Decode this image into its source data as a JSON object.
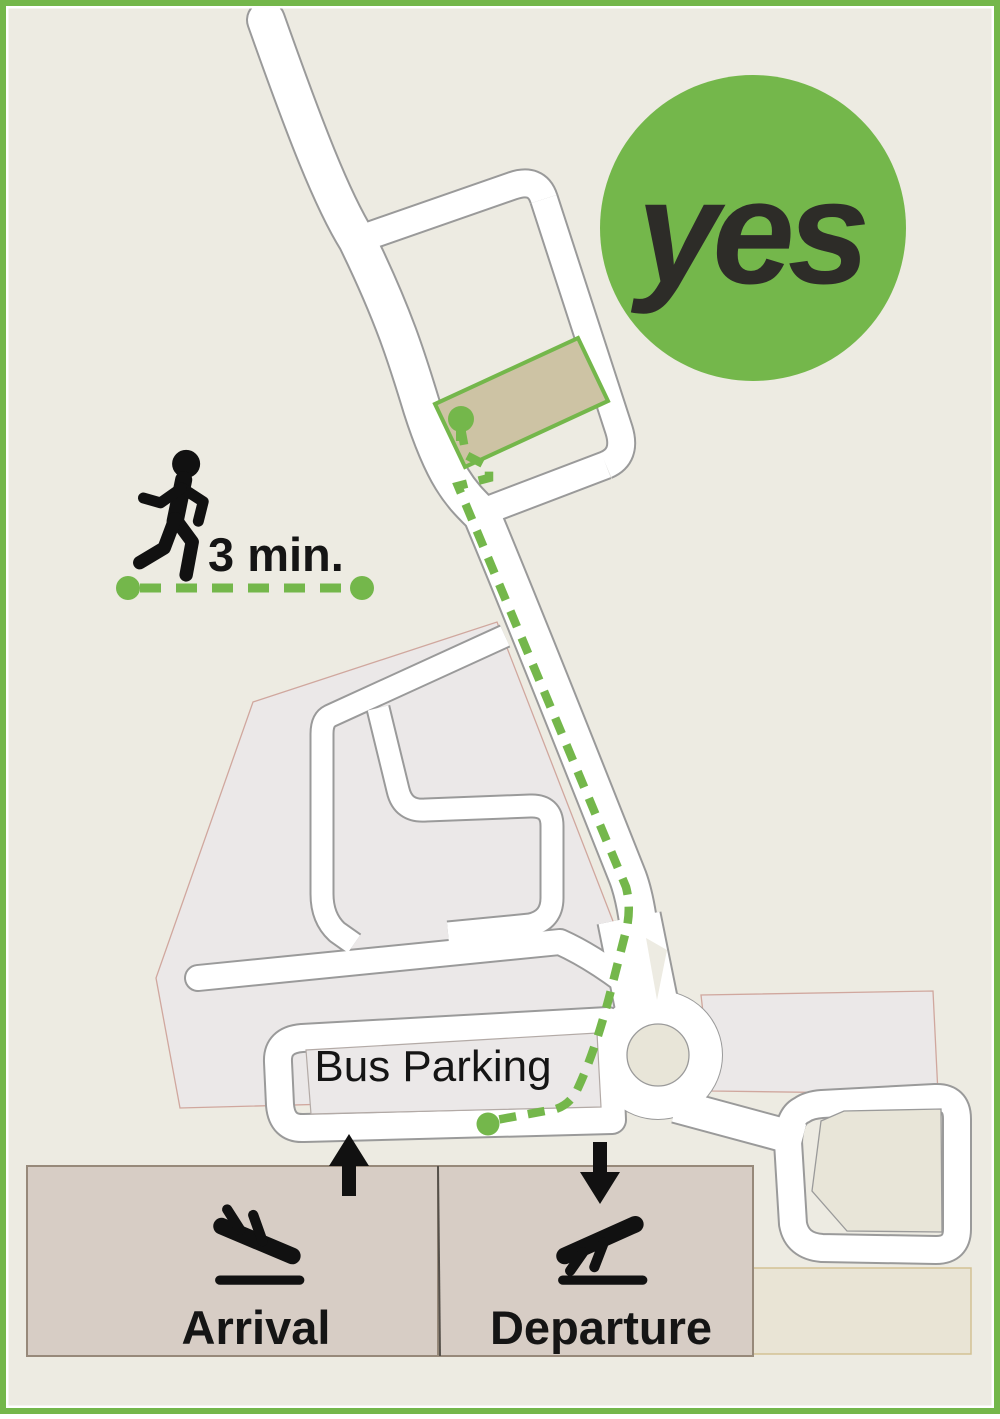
{
  "logo": {
    "text": "yes",
    "circle_color": "#74b74b",
    "text_color": "#2d2c28"
  },
  "walk_indicator": {
    "duration": "3 min.",
    "icon": "walking-person",
    "line_color": "#74b74b"
  },
  "map": {
    "bus_parking": {
      "label": "Bus Parking"
    },
    "terminals": {
      "arrival": {
        "label": "Arrival",
        "icon": "plane-landing",
        "direction_icon": "arrow-up"
      },
      "departure": {
        "label": "Departure",
        "icon": "plane-takeoff",
        "direction_icon": "arrow-down"
      }
    },
    "route": {
      "color": "#74b74b",
      "style": "dashed",
      "start_marker": "green-dot",
      "end_marker": "green-pin"
    },
    "destination": {
      "building_outline": "#74b74b",
      "building_fill": "#cdc3a4"
    }
  },
  "colors": {
    "background": "#edebe2",
    "frame": "#74b74b",
    "road_fill": "#ffffff",
    "road_casing": "#9a9a9a",
    "parking_area_fill": "#ebe8e8",
    "parking_area_outline": "#d0a79e",
    "island_fill": "#e8e5d8",
    "terminal_fill": "#d7cdc5",
    "terminal_outline": "#97897a",
    "apron_fill": "#e9e4d5"
  }
}
